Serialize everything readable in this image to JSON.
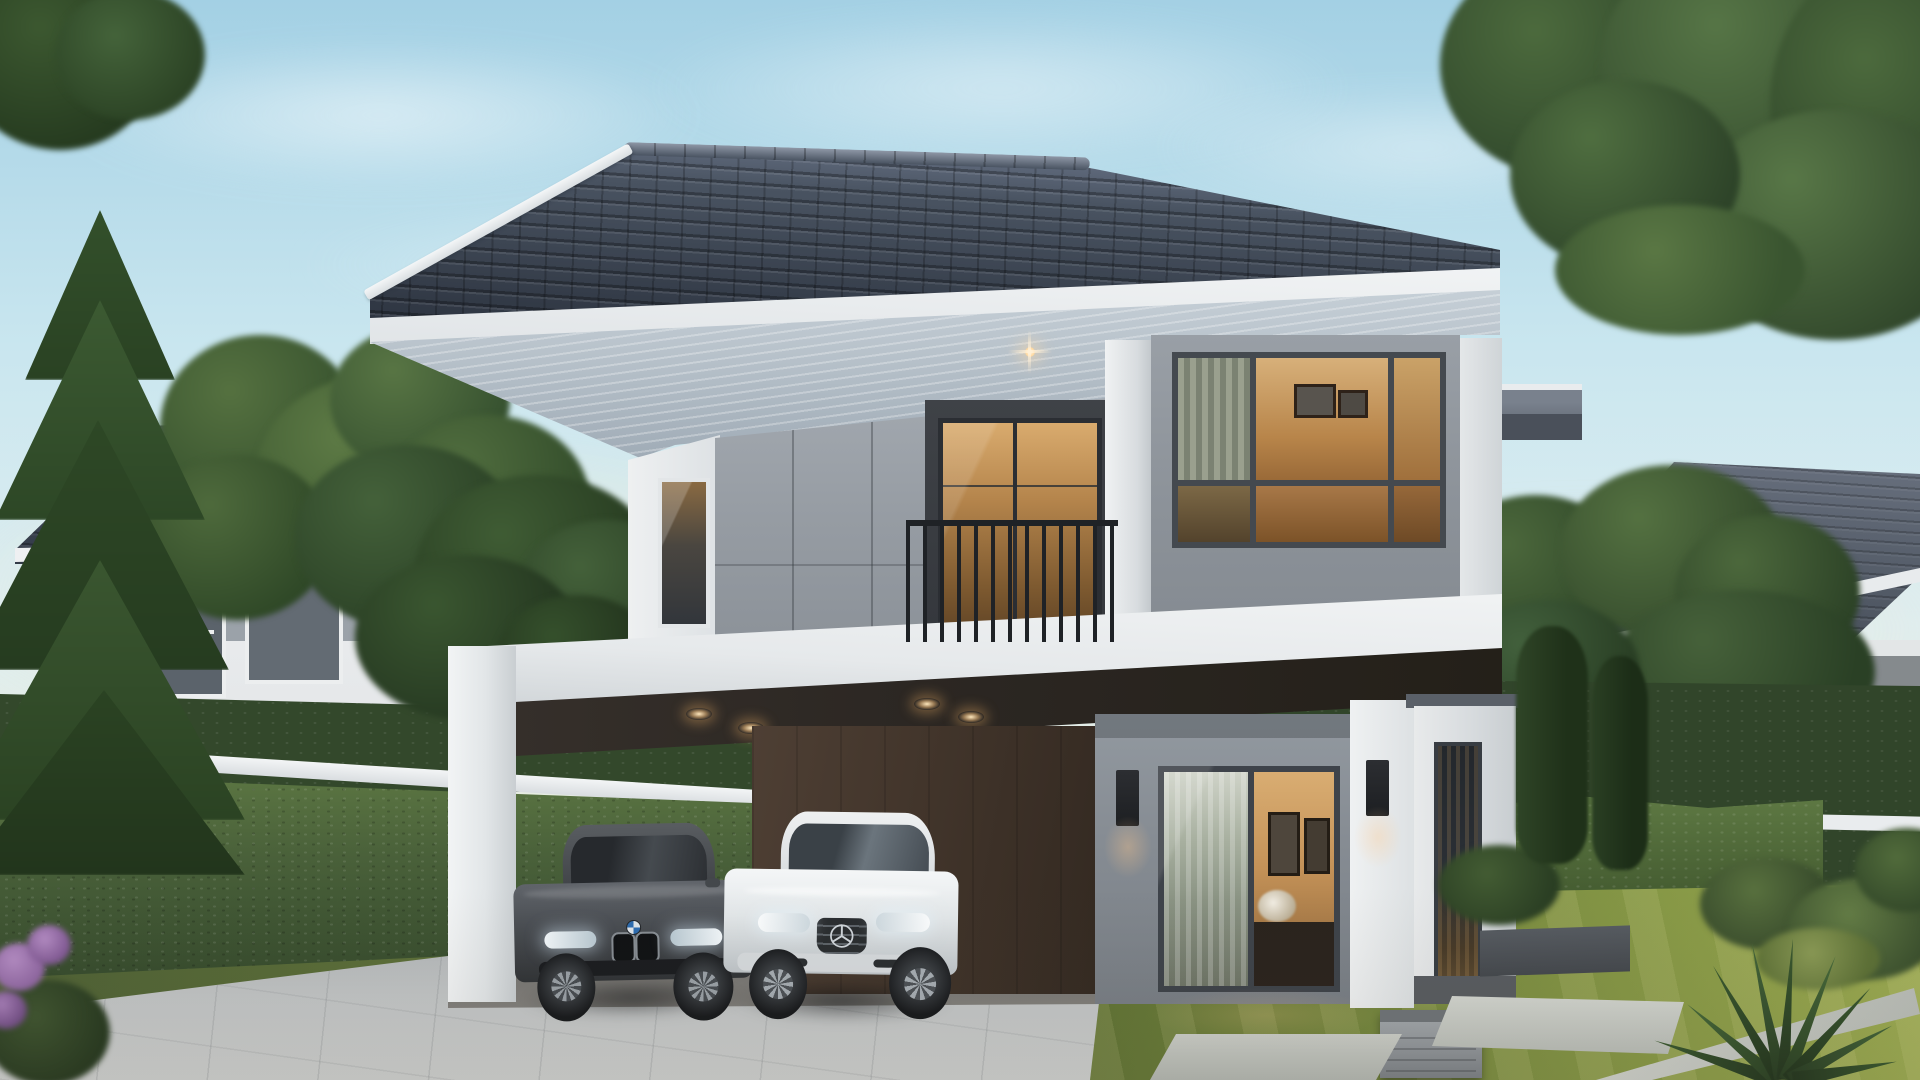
{
  "scene": {
    "type": "3d-architectural-exterior-rendering",
    "subject": "Modern two-storey detached house at dusk with open double carport, two parked cars (dark grey BMW sedan and white Mercedes coupe), warm interior lighting, balcony, landscaped lawn with stepping stones, perimeter hedge walls, pine and deciduous trees, and two neighbouring houses",
    "time_of_day": "dusk",
    "objects": [
      "sky-with-soft-clouds",
      "main-house",
      "dark-tiled-hip-roof",
      "upper-floor-grey-panel-wall",
      "balcony-with-black-railing",
      "balcony-sliding-door-lit",
      "corner-bedroom-window-lit",
      "narrow-stair-window",
      "inter-floor-white-band",
      "carport-white-frame",
      "carport-downlights",
      "carport-brown-back-wall",
      "ground-floor-sliding-door-lit",
      "living-room-interior",
      "wall-sconce-left",
      "wall-sconce-right",
      "side-wing-wall",
      "tall-side-window",
      "ac-unit",
      "bmw-dark-grey-sedan",
      "mercedes-white-coupe",
      "paver-driveway",
      "lawn",
      "stepping-stones",
      "concrete-curb",
      "perimeter-hedge",
      "white-fence-rail",
      "pine-tree",
      "deciduous-trees",
      "cypress-trees",
      "purple-flower-bush",
      "spiky-plant",
      "left-neighbour-house",
      "right-neighbour-house"
    ],
    "palette": {
      "sky_top": "#a3d0e4",
      "sky_mid": "#c9e6ef",
      "sky_low": "#dfeef0",
      "sky_horizon": "#efe8d0",
      "roof_dark": "#2c333f",
      "roof_mid": "#495361",
      "roof_light": "#78839a",
      "ridge": "#8e97a6",
      "fascia": "#f0f2f4",
      "soffit_light": "#ccd5dc",
      "soffit_dark": "#9da9b4",
      "wall_white": "#eceeef",
      "wall_gray": "#989ea6",
      "frame_dark": "#41464d",
      "warm_hi": "#d8a968",
      "warm_mid": "#b07c42",
      "warm_deep": "#7e5526",
      "rail_black": "#1f2226",
      "ceil_dark": "#322d29",
      "carport_brown": "#46382e",
      "glow_warm": "#ffd9a0",
      "drive": "#bdc1c3",
      "lawn": "#77893f",
      "lawn_dark": "#566832",
      "hedge": "#4a613a",
      "hedge_dark": "#33482b",
      "hedge_light": "#5f7a44",
      "tree": "#4b693b",
      "tree_dark": "#2f462a",
      "conifer": "#3a5630",
      "bmw_body": "#53575b",
      "merc_body": "#e6e9eb",
      "wheel": "#17191c",
      "curb": "#c9ccc4",
      "flower": "#8d64a0",
      "ac_gray": "#9aa0a4"
    }
  }
}
